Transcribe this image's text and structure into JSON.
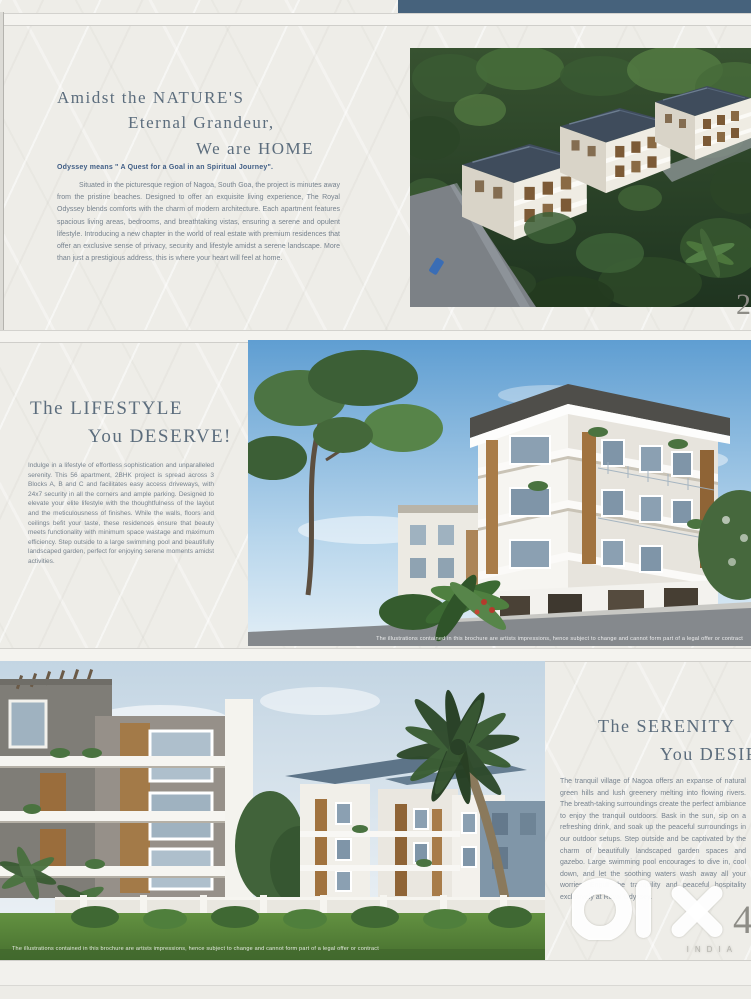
{
  "brochure": {
    "project_name": "Royal Odyssey",
    "sections": {
      "nature": {
        "heading_lines": [
          "Amidst the NATURE'S",
          "Eternal Grandeur,",
          "We are HOME"
        ],
        "intro": "Odyssey means \" A Quest for a Goal in an Spiritual Journey\".",
        "body": "Situated in the picturesque region of Nagoa, South Goa, the project is minutes away from the pristine beaches. Designed to offer an exquisite living experience, The Royal Odyssey blends comforts with the charm of modern architecture. Each apartment features spacious living areas, bedrooms, and breathtaking vistas, ensuring a serene and opulent lifestyle. Introducing a new chapter in the world of real estate with premium residences that offer an exclusive sense of privacy, security and lifestyle amidst a serene landscape. More than just a prestigious address, this is where your heart will feel at home.",
        "page_number": "2"
      },
      "lifestyle": {
        "heading_lines": [
          "The LIFESTYLE",
          "You DESERVE!"
        ],
        "body": "Indulge in a lifestyle of effortless sophistication and unparalleled serenity. This 56 apartment, 2BHK project is spread across 3 Blocks A, B and C and facilitates easy access driveways, with 24x7 security in all the corners and ample parking. Designed to elevate your elite lifestyle with the thoughtfulness of the layout and the meticulousness of finishes. While the walls, floors and ceilings befit your taste, these residences ensure that beauty meets functionality with minimum space wastage and maximum efficiency. Step outside to a large swimming pool and beautifully landscaped garden, perfect for enjoying serene moments amidst activities.",
        "photo_caption": "The illustrations contained in this brochure are artists impressions, hence subject to change and cannot form part of a legal offer or contract"
      },
      "serenity": {
        "heading_lines": [
          "The SERENITY",
          "You DESIRE"
        ],
        "body": "The tranquil village of Nagoa offers an expanse of natural green hills and lush greenery melting into flowing rivers. The breath-taking surroundings create the perfect ambiance to enjoy the tranquil outdoors. Bask in the sun, sip on a refreshing drink, and soak up the peaceful surroundings in our outdoor setups. Step outside and be captivated by the charm of beautifully landscaped garden spaces and gazebo. Large swimming pool encourages to dive in, cool down, and let the soothing waters wash away all your worries. Engulf the tranquility and peaceful hospitality exclusively at Royal Odyssey.",
        "photo_caption": "The illustrations contained in this brochure are artists impressions, hence subject to change and cannot form part of a legal offer or contract",
        "page_number": "4"
      }
    },
    "watermark": {
      "logo": "olx",
      "region": "INDIA"
    },
    "colors": {
      "paper": "#eeede8",
      "heading": "#5c6d7d",
      "intro_accent": "#3f5d85",
      "body_text": "#76828e",
      "top_bar": "#46627c",
      "watermark": "#ffffff"
    }
  }
}
